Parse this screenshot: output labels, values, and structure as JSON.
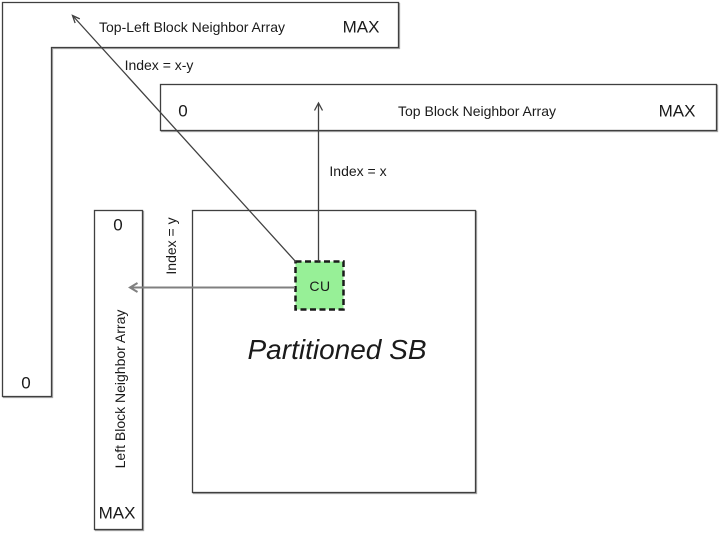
{
  "diagram": {
    "colors": {
      "background": "#ffffff",
      "box_fill": "#ffffff",
      "box_border": "#3f3f3f",
      "cu_fill": "#97F097",
      "cu_border": "#1a1a1a",
      "arrow_dark": "#404040",
      "arrow_gray": "#808080",
      "text": "#1a1a1a"
    },
    "top_left_array": {
      "label": "Top-Left Block Neighbor Array",
      "max": "MAX",
      "zero": "0"
    },
    "top_array": {
      "zero": "0",
      "label": "Top Block Neighbor Array",
      "max": "MAX"
    },
    "left_array": {
      "zero": "0",
      "label": "Left Block Neighbor Array",
      "max": "MAX"
    },
    "partitioned_sb": {
      "label": "Partitioned SB"
    },
    "cu": {
      "label": "CU"
    },
    "index_labels": {
      "top_left": "Index = x-y",
      "top": "Index = x",
      "left": "Index = y"
    }
  }
}
